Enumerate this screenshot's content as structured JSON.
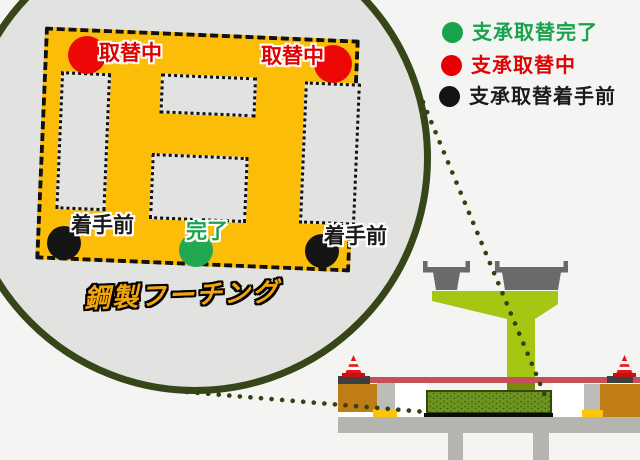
{
  "diagram": {
    "type": "bridge-bearing-replacement-status",
    "background_color": "#f4f4f3"
  },
  "legend": {
    "items": [
      {
        "label": "支承取替完了",
        "status": "completed",
        "color": "#1aa34d"
      },
      {
        "label": "支承取替中",
        "status": "in-progress",
        "color": "#e80000"
      },
      {
        "label": "支承取替着手前",
        "status": "not-started",
        "color": "#141414"
      }
    ]
  },
  "magnifier": {
    "caption": "鋼製フーチング",
    "footing_color": "#fcbd08",
    "markers": [
      {
        "label": "取替中",
        "status": "in-progress",
        "color": "#ee0707",
        "position": "top-left"
      },
      {
        "label": "取替中",
        "status": "in-progress",
        "color": "#ee0707",
        "position": "top-right"
      },
      {
        "label": "着手前",
        "status": "not-started",
        "color": "#151515",
        "position": "bottom-left"
      },
      {
        "label": "完了",
        "status": "completed",
        "color": "#21a851",
        "position": "bottom-center"
      },
      {
        "label": "着手前",
        "status": "not-started",
        "color": "#151515",
        "position": "bottom-right"
      }
    ]
  },
  "bridge": {
    "deck_color": "#c4505a",
    "pier_color": "#a6c614",
    "footing_block_color": "#6e9420",
    "girder_color": "#6a6a6a",
    "cone_color": "#e51515",
    "callout_dot_color": "#33430f"
  }
}
